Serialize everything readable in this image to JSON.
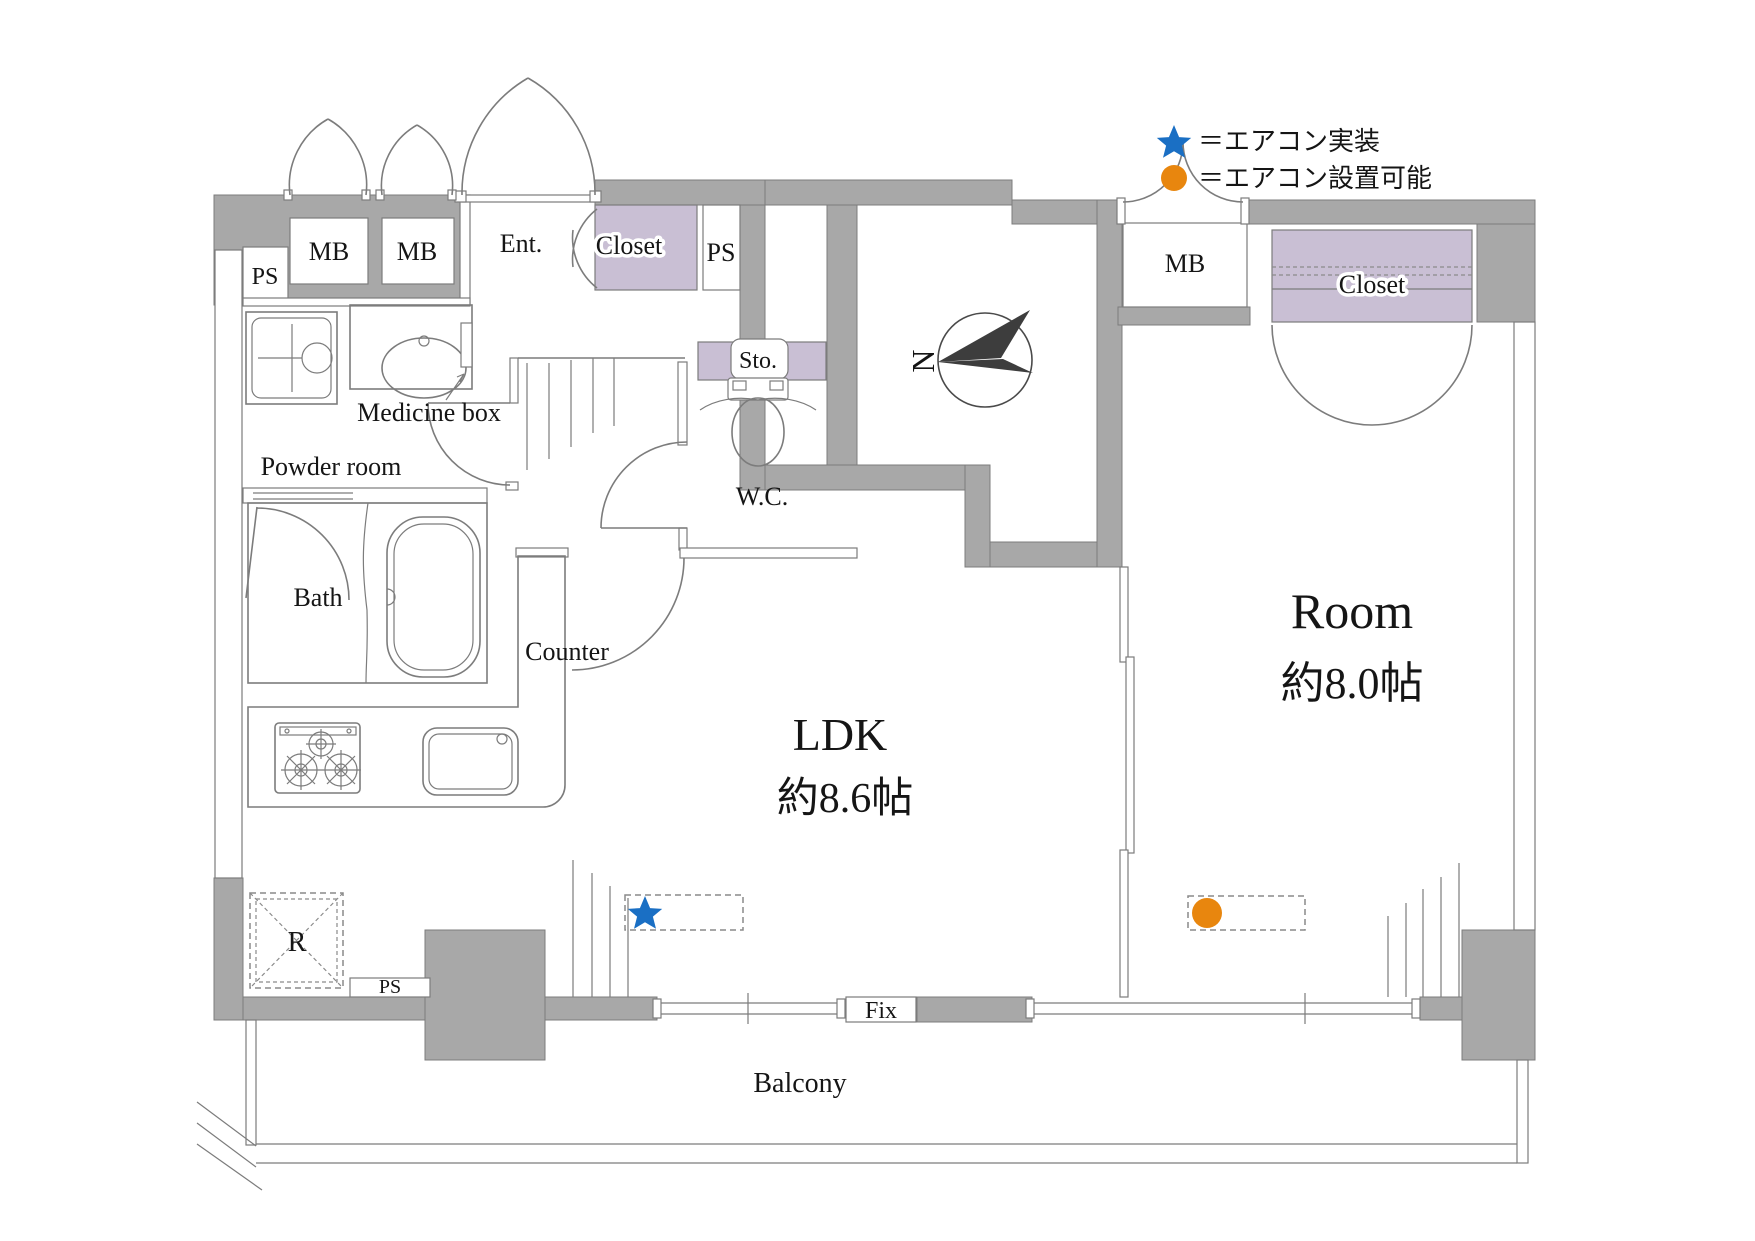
{
  "legend": {
    "star_label": "＝エアコン実装",
    "circle_label": "＝エアコン設置可能"
  },
  "compass": {
    "north": "N"
  },
  "rooms": {
    "ldk": {
      "name": "LDK",
      "size": "約8.6帖"
    },
    "main_room": {
      "name": "Room",
      "size": "約8.0帖"
    },
    "entrance": {
      "name": "Ent."
    },
    "entrance_closet": {
      "name": "Closet"
    },
    "room_closet": {
      "name": "Closet"
    },
    "wc": {
      "name": "W.C."
    },
    "storage": {
      "name": "Sto."
    },
    "bath": {
      "name": "Bath"
    },
    "powder": {
      "name": "Powder room"
    },
    "balcony": {
      "name": "Balcony"
    }
  },
  "labels": {
    "mb": "MB",
    "ps": "PS",
    "counter": "Counter",
    "medicine_box": "Medicine box",
    "refrigerator": "R",
    "fix": "Fix"
  },
  "colors": {
    "wall": "#a8a8a8",
    "wall_line": "#7c7c7c",
    "closet": "#c9bfd4",
    "ac_installed": "#1a6fc4",
    "ac_possible": "#e8860e",
    "compass": "#3d3d3d"
  }
}
